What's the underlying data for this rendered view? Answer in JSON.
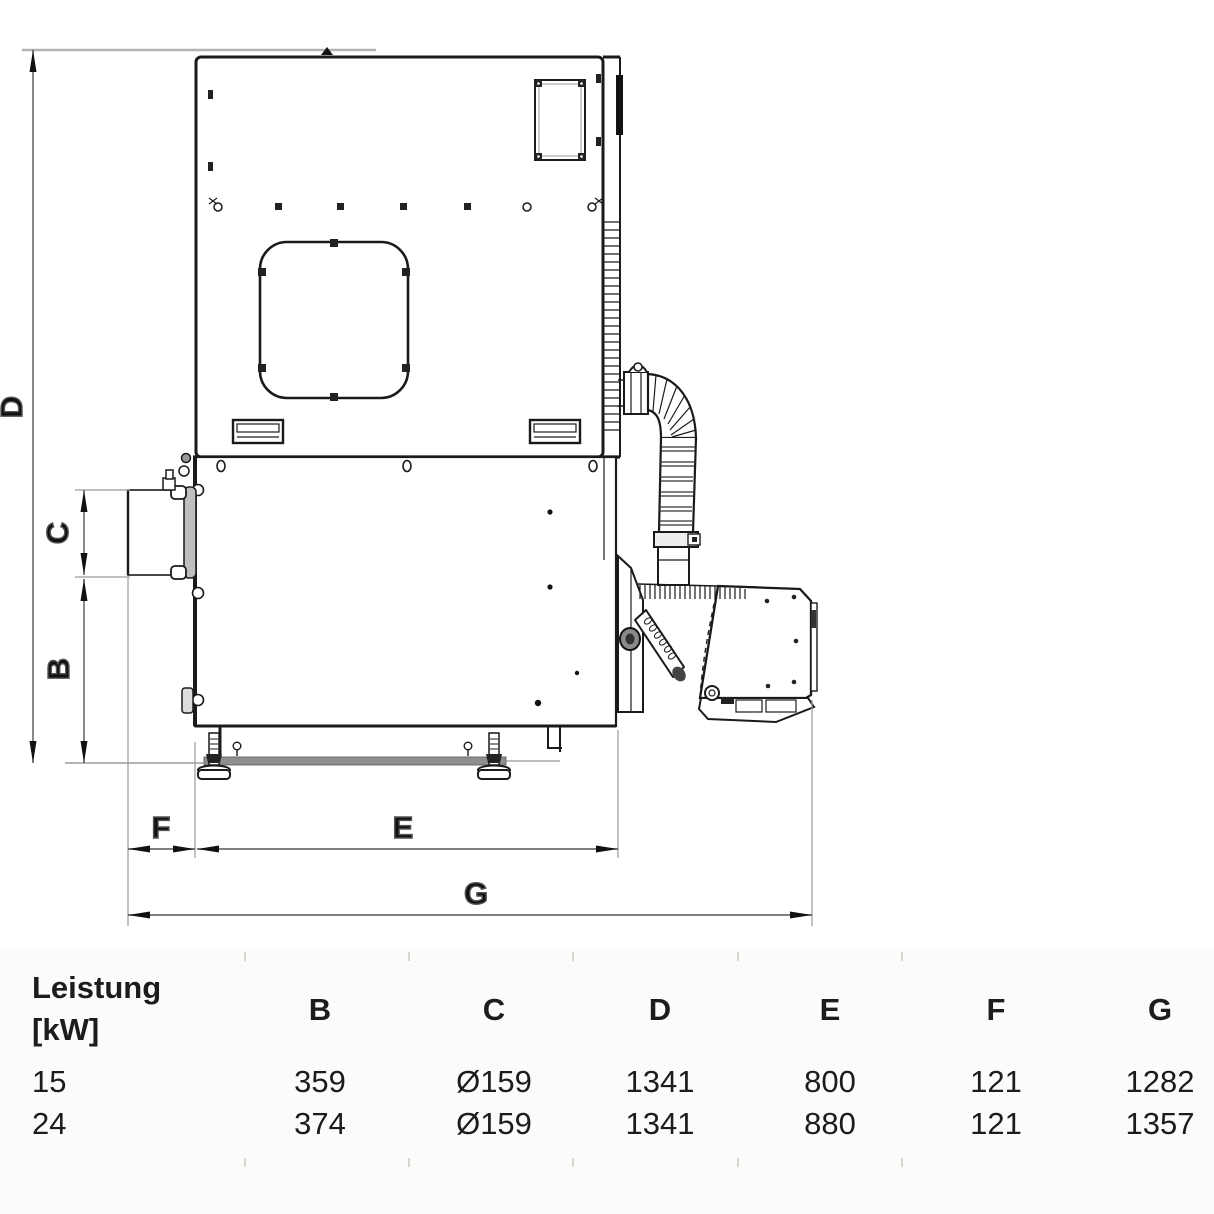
{
  "drawing": {
    "description": "side-view technical dimension drawing of pellet boiler with flexible hose and burner",
    "dim_labels": {
      "D": "D",
      "C": "C",
      "B": "B",
      "F": "F",
      "E": "E",
      "G": "G"
    }
  },
  "table": {
    "row_header": {
      "line1": "Leistung",
      "line2": "[kW]"
    },
    "columns": [
      "B",
      "C",
      "D",
      "E",
      "F",
      "G"
    ],
    "rows": [
      {
        "power": "15",
        "values": [
          "359",
          "Ø159",
          "1341",
          "800",
          "121",
          "1282"
        ]
      },
      {
        "power": "24",
        "values": [
          "374",
          "Ø159",
          "1341",
          "880",
          "121",
          "1357"
        ]
      }
    ]
  },
  "colors": {
    "line": "#1a1a1a",
    "dim_line": "#555555",
    "ext_line": "#9a9a9a",
    "text": "#111111"
  }
}
